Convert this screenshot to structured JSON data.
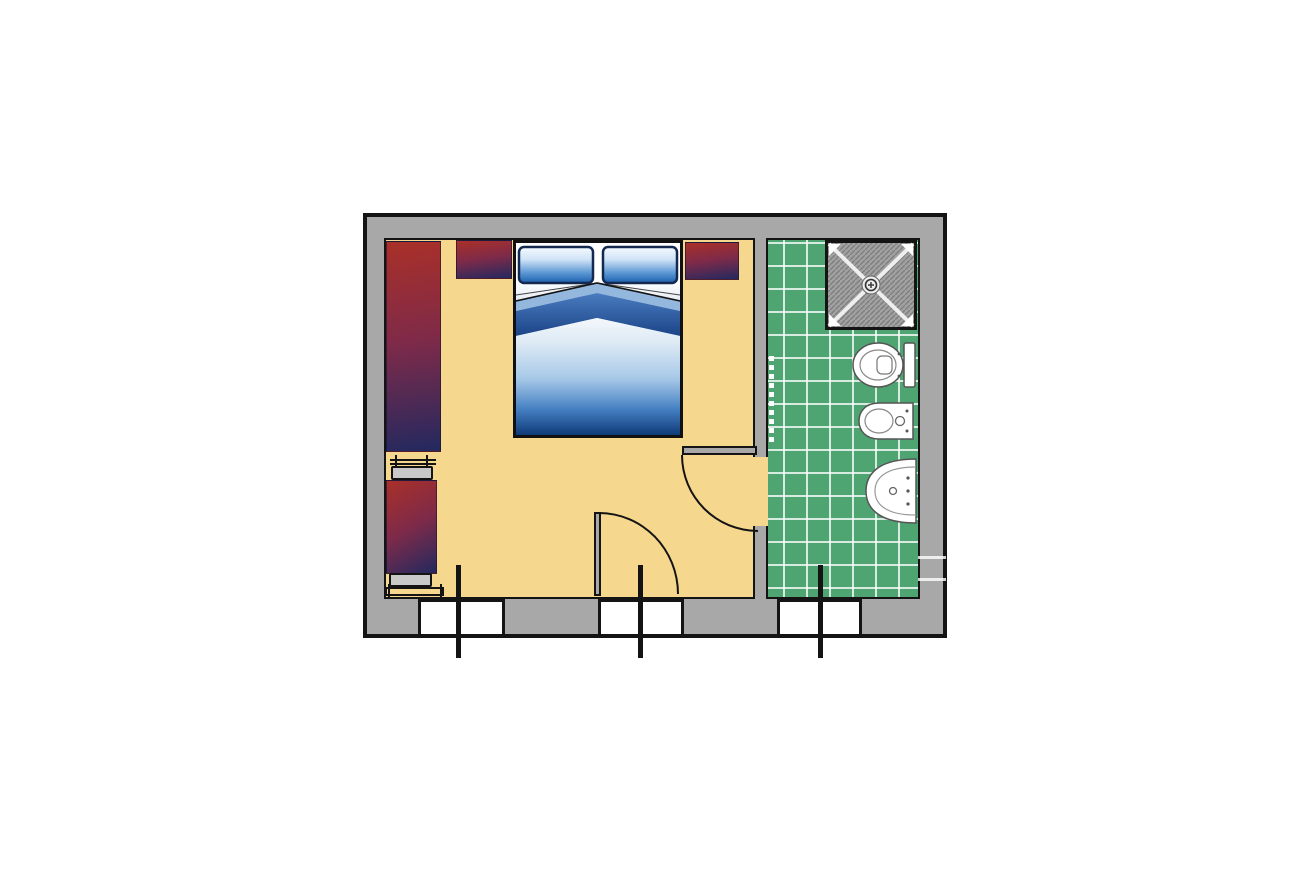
{
  "document": {
    "type": "floor-plan",
    "subject": "hotel double room with en-suite bathroom",
    "visible_text": []
  },
  "colors": {
    "wall_fill": "#a8a8a8",
    "wall_outline": "#141414",
    "bedroom_floor": "#f6d78e",
    "bathroom_tile": "#4ea572",
    "tile_grout": "#e9f5ec",
    "furniture_red": "#a93028",
    "furniture_purple": "#7e2a49",
    "furniture_navy": "#23295f",
    "bench_gray": "#c9c9c9",
    "window_fill": "#ffffff",
    "bed_border": "#111111",
    "pillow_blue": "#1b5fae",
    "blanket_navy": "#0f3a78",
    "band_navy": "#1c4488",
    "band_light": "#93b7dd",
    "shower_gray": "#a2a2a2",
    "shower_hatch": "#7e7e7e",
    "fixture_fill": "#ffffff",
    "fixture_stroke": "#555555"
  },
  "bedroom": {
    "furniture": [
      {
        "name": "double-bed",
        "detail": "two pillows, folded blue blanket"
      },
      {
        "name": "wardrobe"
      },
      {
        "name": "nightstand-left"
      },
      {
        "name": "nightstand-right"
      },
      {
        "name": "armchair-daybed"
      },
      {
        "name": "luggage-bench-top"
      },
      {
        "name": "luggage-bench-bottom"
      }
    ]
  },
  "bathroom": {
    "fixtures": [
      {
        "name": "shower-tray"
      },
      {
        "name": "toilet"
      },
      {
        "name": "bidet"
      },
      {
        "name": "washbasin"
      },
      {
        "name": "towel-rail"
      }
    ]
  },
  "openings": {
    "windows": [
      {
        "name": "bedroom-window-left"
      },
      {
        "name": "bedroom-french-door"
      },
      {
        "name": "bathroom-window"
      }
    ],
    "doors": [
      {
        "name": "entry-door",
        "swing": "quarter-arc"
      },
      {
        "name": "bathroom-door",
        "swing": "quarter-arc"
      }
    ]
  }
}
